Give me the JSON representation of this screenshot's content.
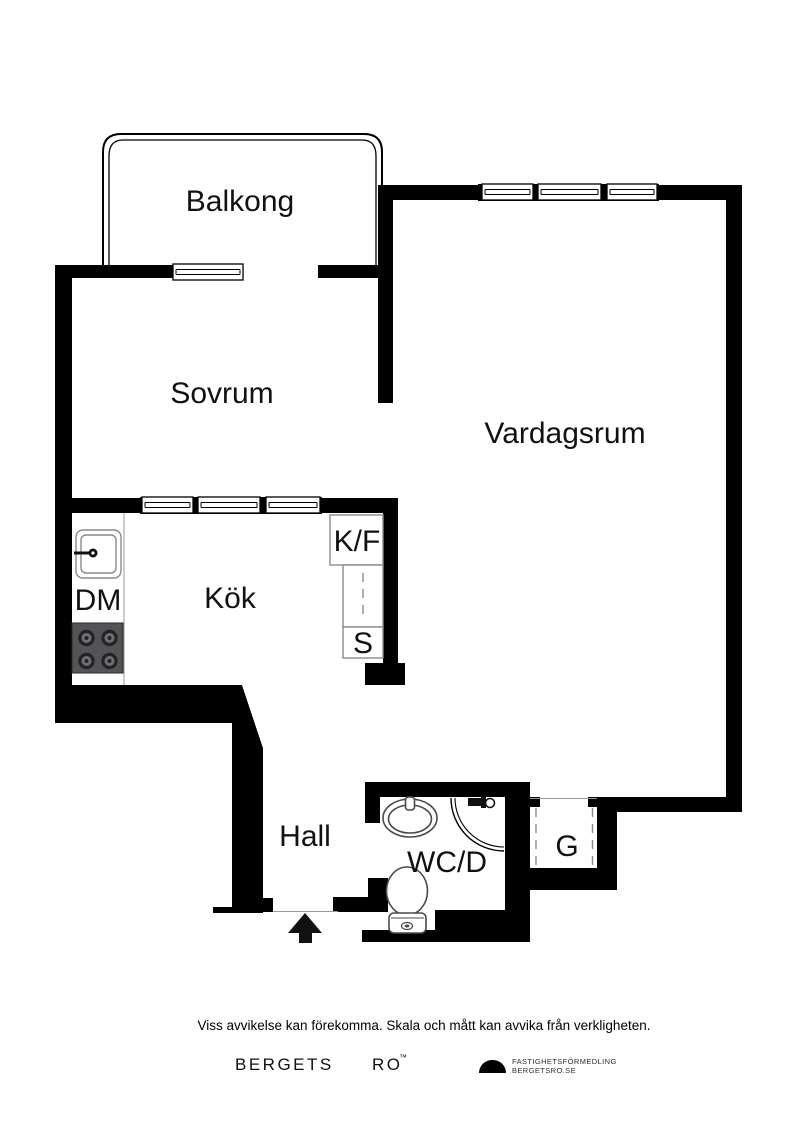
{
  "plan": {
    "labels": {
      "balkong": "Balkong",
      "sovrum": "Sovrum",
      "vardagsrum": "Vardagsrum",
      "kok": "Kök",
      "hall": "Hall",
      "wcd": "WC/D",
      "garderob": "G",
      "dm": "DM",
      "kf": "K/F",
      "s": "S"
    },
    "colors": {
      "wall": "#000000",
      "stove": "#545457",
      "stove_burner_dark": "#232325",
      "stove_burner_light": "#6f6f72",
      "cabinet": "#8a8a8a",
      "fixture": "#4a4a4a",
      "text": "#111111"
    }
  },
  "footer": {
    "disclaimer": "Viss avvikelse kan förekomma. Skala och mått kan avvika från verkligheten.",
    "brand_word1": "BERGETS",
    "brand_word2": "RO",
    "brand_mark": "™",
    "logo_line1": "FASTIGHETSFÖRMEDLING",
    "logo_line2": "BERGETSRO.SE"
  }
}
